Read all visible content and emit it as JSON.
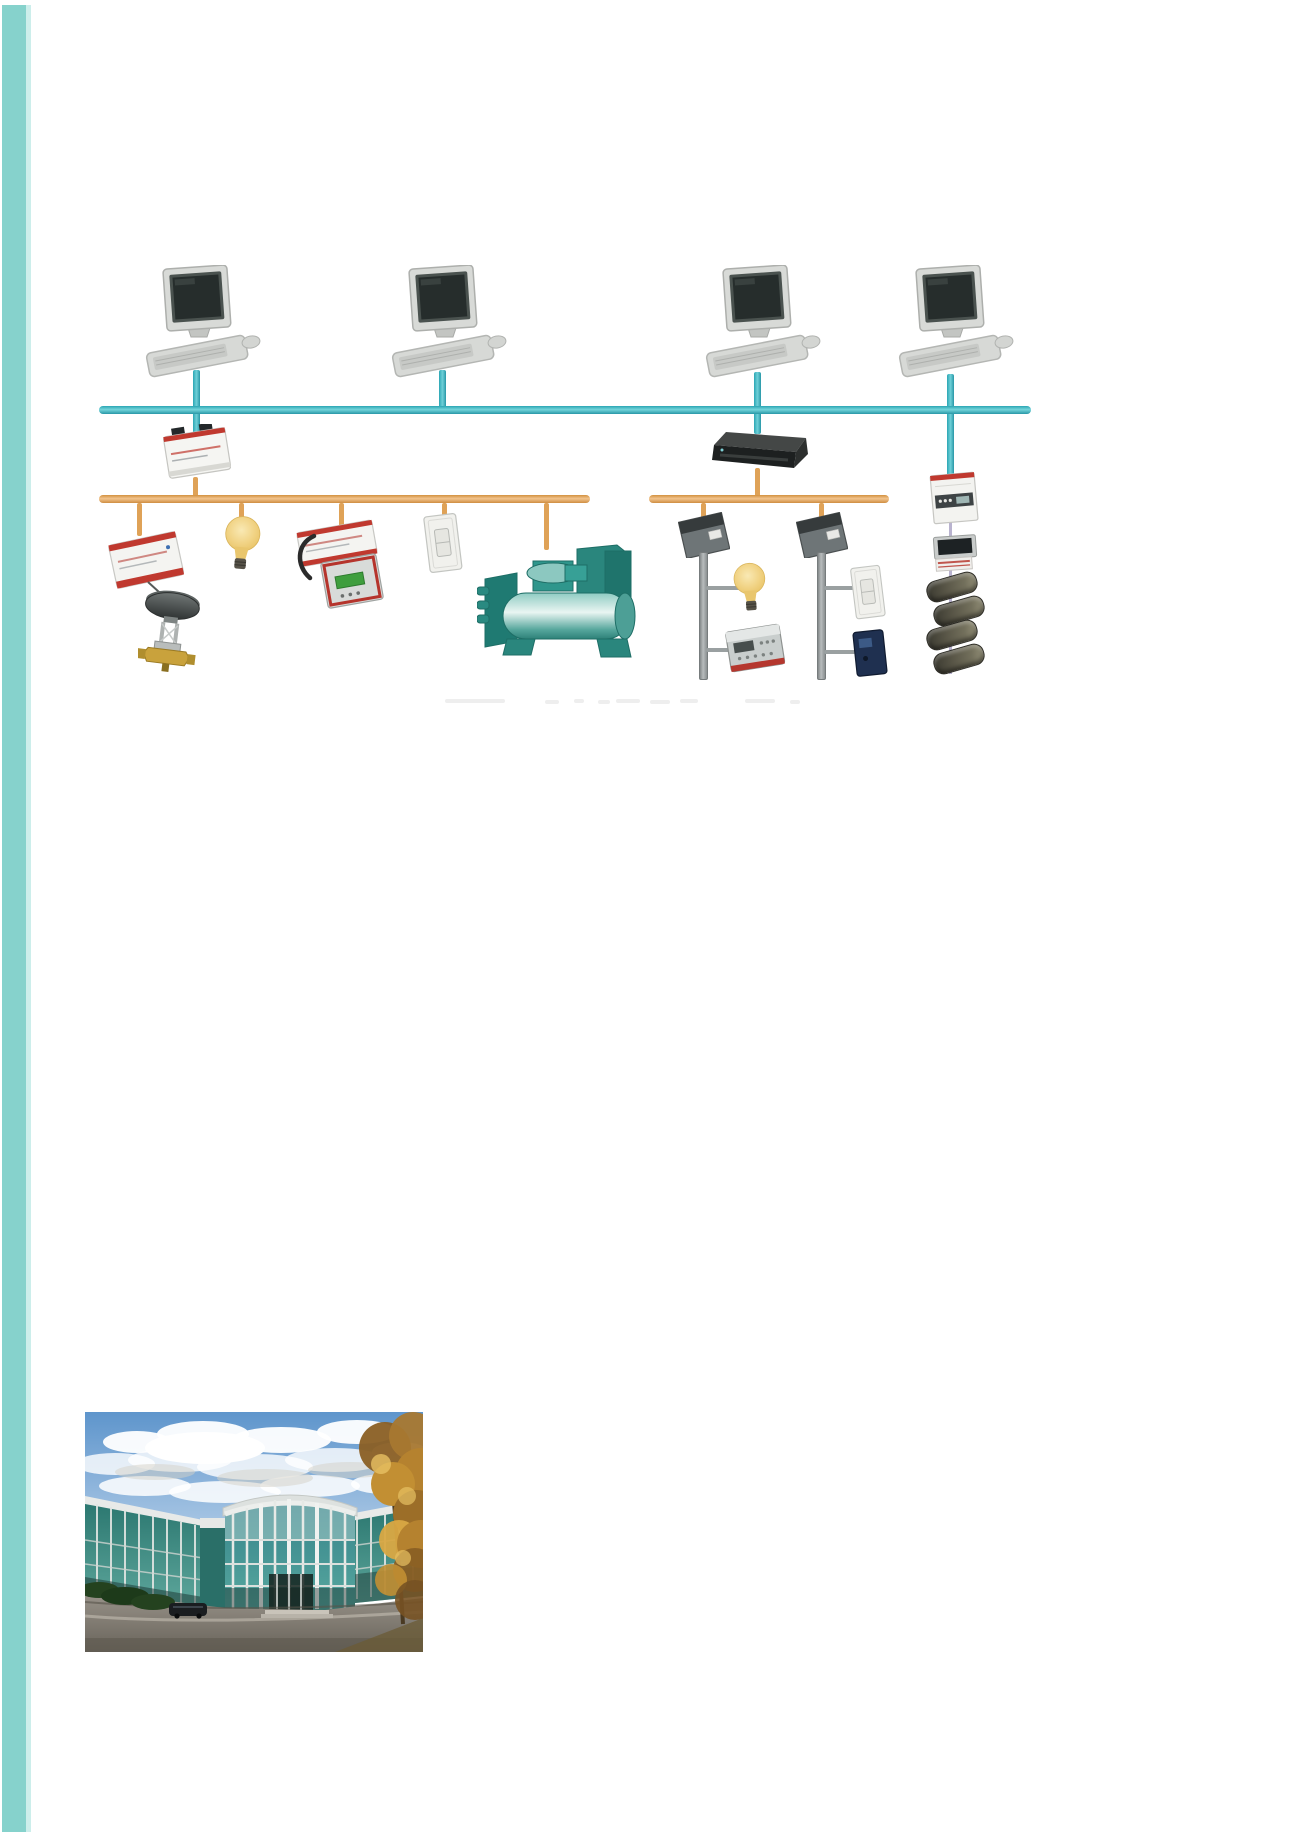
{
  "colors": {
    "page_bg": "#ffffff",
    "stripe_teal": "#86d2cc",
    "stripe_teal_edge": "#cceeeb",
    "backbone_bus": "#2fb0bd",
    "backbone_bus_light": "#74d4da",
    "field_bus": "#dfa257",
    "field_bus_light": "#f2c48d",
    "branch_gray": "#9aa0a1",
    "meter_line_lavender": "#b9b3cf",
    "device_red": "#c0392f",
    "chiller_teal": "#2f968c"
  },
  "diagram": {
    "name": "building-automation-network-topology",
    "backbone_bus": "ip-backbone",
    "workstations": [
      "workstation-1",
      "workstation-2",
      "workstation-3",
      "workstation-4"
    ],
    "segments": [
      {
        "name": "field-bus-left",
        "head_device": "network-interface-module",
        "devices": [
          "io-controller",
          "valve-actuator",
          "light-bulb",
          "controller-with-keypad",
          "wall-switch",
          "chiller"
        ]
      },
      {
        "name": "field-bus-right",
        "head_device": "router",
        "devices": [
          "junction-box",
          "light-bulb",
          "keypad-controller",
          "junction-box",
          "dimmer-switch",
          "card-reader"
        ]
      },
      {
        "name": "meter-drop",
        "devices": [
          "din-rail-meter",
          "lcd-display",
          "terminal-strip",
          "coil-stack"
        ]
      }
    ]
  },
  "photo": {
    "name": "glass-office-building",
    "description": "glass office building with rotunda entrance, cloudy sky, autumn tree and driveway"
  }
}
